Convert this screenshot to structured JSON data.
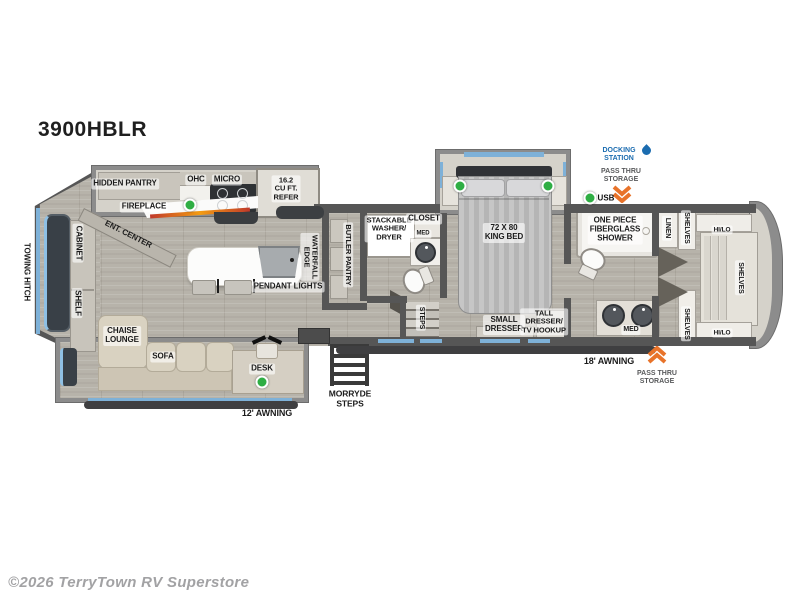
{
  "title": "3900HBLR",
  "copyright": "©2026 TerryTown RV Superstore",
  "colors": {
    "wall": "#565656",
    "floor": "#b7b3aa",
    "window_blue": "#7eb1d8",
    "led_green": "#2fae44",
    "arrow_orange": "#e8732a",
    "docking_blue": "#1b6cb0"
  },
  "labels": {
    "hidden_pantry": "HIDDEN PANTRY",
    "ohc": "OHC",
    "micro": "MICRO",
    "refer": "16.2\nCU FT.\nREFER",
    "fireplace": "FIREPLACE",
    "ent_center": "ENT. CENTER",
    "cabinet": "CABINET",
    "shelf": "SHELF",
    "towing_hitch": "TOWING HITCH",
    "chaise_lounge": "CHAISE\nLOUNGE",
    "sofa": "SOFA",
    "desk": "DESK",
    "awning_12": "12' AWNING",
    "morryde_steps": "MORRYDE\nSTEPS",
    "pendant_lights": "PENDANT LIGHTS",
    "waterfall_edge": "WATERFALL\nEDGE",
    "butler_pantry": "BUTLER PANTRY",
    "washer_dryer": "STACKABLE\nWASHER/\nDRYER",
    "closet": "CLOSET",
    "med": "MED",
    "steps": "STEPS",
    "king_bed": "72 X 80\nKING BED",
    "small_dresser": "SMALL\nDRESSER",
    "tall_dresser": "TALL\nDRESSER/\nTV HOOKUP",
    "shower": "ONE PIECE\nFIBERGLASS\nSHOWER",
    "linen": "LINEN",
    "shelves": "SHELVES",
    "hi_lo": "HI/LO",
    "docking_station": "DOCKING\nSTATION",
    "pass_thru": "PASS THRU\nSTORAGE",
    "usb": "USB",
    "awning_18": "18' AWNING"
  }
}
